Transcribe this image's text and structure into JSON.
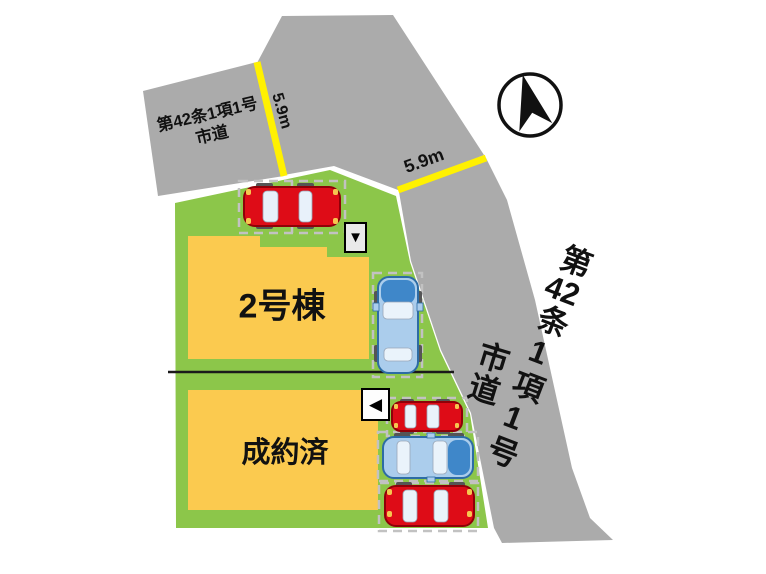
{
  "compass": {
    "icon": "north-arrow"
  },
  "roads": {
    "left": {
      "name_line1": "第42条1項1号",
      "name_line2": "市道",
      "width_label": "5.9m"
    },
    "north": {
      "width_label": "5.9m"
    },
    "right": {
      "name_full": "第42条1項1号市道",
      "name_start": "第",
      "name_number": "42",
      "name_rest": "条1項1号",
      "name_type": "市道"
    }
  },
  "plots": [
    {
      "building_label": "2号棟",
      "marker_icon": "▼",
      "cars": [
        {
          "color_name": "red",
          "orientation": "horizontal"
        },
        {
          "color_name": "blue",
          "orientation": "vertical"
        }
      ]
    },
    {
      "building_label": "成約済",
      "marker_icon": "◀",
      "cars": [
        {
          "color_name": "red",
          "orientation": "horizontal"
        },
        {
          "color_name": "blue",
          "orientation": "horizontal"
        },
        {
          "color_name": "red",
          "orientation": "horizontal"
        }
      ]
    }
  ],
  "colors": {
    "road": "#ABABAB",
    "road_width_line": "#FFF101",
    "plot_green": "#8CC64A",
    "building_yellow": "#FBCA4F",
    "car_red": "#DE0C17",
    "car_blue": "#ABCDEC",
    "car_blue_dark": "#3F87C9",
    "compass_black": "#111111"
  }
}
